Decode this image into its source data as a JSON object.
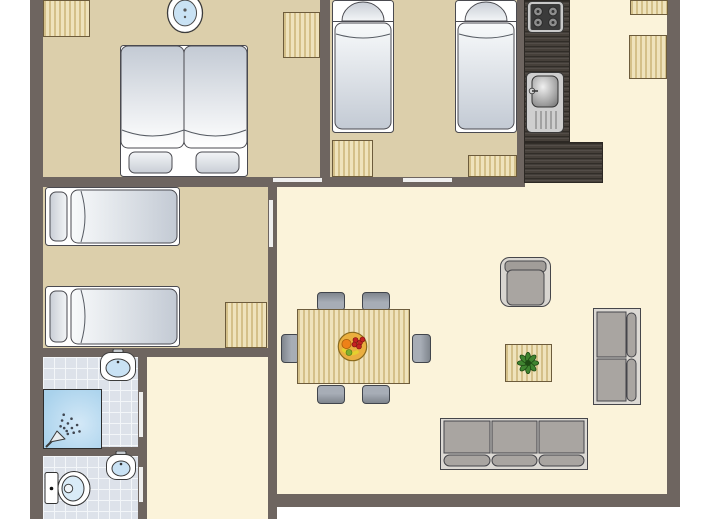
{
  "canvas": {
    "width": 713,
    "height": 519,
    "background": "#ffffff"
  },
  "palette": {
    "wall": "#6e6560",
    "door": "#efefef",
    "floor_bedroom": "#dccfab",
    "floor_living": "#fbf3da",
    "floor_tile": "#dde2ea",
    "tile_line": "#f3f6f9",
    "wood": "#e9d9a7",
    "wood_edge": "#6d5c3c",
    "counter_wood": "#46403a",
    "counter_edge": "#2c2824",
    "outline": "#4a4a50",
    "white": "#ffffff",
    "mattress_light": "#f8fafb",
    "mattress_dark": "#c3cad4",
    "pillow_light": "#f3f5f7",
    "pillow_dark": "#c9ced6",
    "cushion": "#a9a5a1",
    "sofa_frame": "#dcd9d4",
    "armchair_frame": "#d8d5d0",
    "armchair_back": "#a19d99",
    "chair_light": "#a7adb6",
    "chair_dark": "#7f858d",
    "metal_light": "#c9c9c9",
    "metal_dark": "#3b3b3b",
    "burner": "#8e8e8e",
    "sink_blue": "#c9e2f4",
    "shower_blue_1": "#d3e8f7",
    "shower_blue_2": "#a9d2ec",
    "plant_leaf": "#3f8430",
    "plant_dark": "#1e4a14",
    "fruit_base": "#eaaf3f",
    "fruit_red": "#c32222",
    "fruit_orange": "#ee8118",
    "fruit_yellow": "#e6cf2e",
    "fruit_green": "#7fae2e"
  },
  "floors": [
    {
      "name": "bedroom-1-floor",
      "kind": "tan",
      "rect": [
        43,
        0,
        277,
        177
      ]
    },
    {
      "name": "bedroom-2-floor",
      "kind": "tan",
      "rect": [
        330,
        0,
        187,
        177
      ]
    },
    {
      "name": "bedroom-3-floor",
      "kind": "tan",
      "rect": [
        43,
        187,
        225,
        161
      ]
    },
    {
      "name": "bathroom-floor",
      "kind": "tile",
      "rect": [
        43,
        357,
        95,
        90
      ]
    },
    {
      "name": "toilet-floor",
      "kind": "tile",
      "rect": [
        43,
        456,
        95,
        63
      ]
    },
    {
      "name": "hallway-floor",
      "kind": "cream",
      "rect": [
        147,
        357,
        121,
        162
      ]
    },
    {
      "name": "kitchen-floor",
      "kind": "cream",
      "rect": [
        524,
        0,
        143,
        187
      ]
    },
    {
      "name": "living-room-floor",
      "kind": "cream",
      "rect": [
        277,
        187,
        390,
        307
      ]
    }
  ],
  "walls": [
    {
      "name": "outer-wall-left",
      "rect": [
        30,
        0,
        13,
        519
      ]
    },
    {
      "name": "outer-wall-right",
      "rect": [
        667,
        0,
        13,
        507
      ]
    },
    {
      "name": "outer-wall-bottom",
      "rect": [
        268,
        494,
        412,
        13
      ]
    },
    {
      "name": "wall-bedrooms-south",
      "rect": [
        43,
        177,
        482,
        10
      ]
    },
    {
      "name": "wall-bedroom1-bedroom2",
      "rect": [
        320,
        0,
        10,
        177
      ]
    },
    {
      "name": "wall-bedroom2-kitchen",
      "rect": [
        517,
        0,
        8,
        183
      ]
    },
    {
      "name": "wall-living-west",
      "rect": [
        268,
        187,
        9,
        332
      ]
    },
    {
      "name": "wall-bedroom3-south",
      "rect": [
        43,
        348,
        234,
        9
      ]
    },
    {
      "name": "wall-bathroom-east",
      "rect": [
        138,
        357,
        9,
        162
      ]
    },
    {
      "name": "wall-bathroom-toilet",
      "rect": [
        30,
        447,
        117,
        9
      ]
    }
  ],
  "door_markers": [
    {
      "name": "door-bedroom1",
      "rect": [
        273,
        178,
        49,
        4
      ]
    },
    {
      "name": "door-bedroom2",
      "rect": [
        403,
        178,
        49,
        4
      ]
    },
    {
      "name": "door-bedroom3",
      "rect": [
        269,
        200,
        4,
        47
      ]
    },
    {
      "name": "door-bathroom",
      "rect": [
        139,
        392,
        4,
        45
      ]
    },
    {
      "name": "door-toilet",
      "rect": [
        139,
        467,
        4,
        35
      ]
    }
  ],
  "furniture": [
    {
      "type": "wood",
      "name": "wardrobe-bedroom1-a",
      "rect": [
        43,
        0,
        47,
        37
      ]
    },
    {
      "type": "wood",
      "name": "wardrobe-bedroom1-b",
      "rect": [
        283,
        12,
        37,
        46
      ]
    },
    {
      "type": "wood",
      "name": "wardrobe-bedroom2-a",
      "rect": [
        332,
        140,
        41,
        37
      ]
    },
    {
      "type": "wood",
      "name": "wardrobe-bedroom2-b",
      "rect": [
        468,
        155,
        49,
        22
      ]
    },
    {
      "type": "wood",
      "name": "wardrobe-bedroom3",
      "rect": [
        225,
        302,
        42,
        46
      ]
    },
    {
      "type": "wood",
      "name": "cabinet-right-a",
      "rect": [
        630,
        0,
        38,
        15
      ]
    },
    {
      "type": "wood",
      "name": "cabinet-right-b",
      "rect": [
        629,
        35,
        38,
        44
      ]
    },
    {
      "type": "counter",
      "name": "kitchen-counter-long",
      "rect": [
        524,
        0,
        46,
        142
      ]
    },
    {
      "type": "counter",
      "name": "kitchen-counter-ell",
      "rect": [
        524,
        142,
        79,
        41
      ]
    },
    {
      "type": "stove",
      "name": "stove",
      "rect": [
        527,
        1,
        37,
        32
      ]
    },
    {
      "type": "kitchen-sink",
      "name": "kitchen-sink",
      "rect": [
        526,
        72,
        38,
        61
      ]
    },
    {
      "type": "bed-double",
      "name": "double-bed",
      "rect": [
        120,
        45,
        128,
        132
      ]
    },
    {
      "type": "bed-single-v",
      "name": "single-bed-a",
      "rect": [
        332,
        0,
        62,
        133
      ]
    },
    {
      "type": "bed-single-v",
      "name": "single-bed-b",
      "rect": [
        455,
        0,
        62,
        133
      ]
    },
    {
      "type": "bed-single-h",
      "name": "single-bed-c",
      "rect": [
        45,
        187,
        135,
        59
      ]
    },
    {
      "type": "bed-single-h",
      "name": "single-bed-d",
      "rect": [
        45,
        286,
        135,
        61
      ]
    },
    {
      "type": "sink-round",
      "name": "washbasin-bedroom1",
      "rect": [
        166,
        -8,
        38,
        42
      ]
    },
    {
      "type": "sink-square",
      "name": "washbasin-bathroom",
      "rect": [
        100,
        349,
        36,
        32
      ]
    },
    {
      "type": "shower",
      "name": "shower",
      "rect": [
        43,
        389,
        59,
        60
      ]
    },
    {
      "type": "sink-square",
      "name": "washbasin-toilet",
      "rect": [
        106,
        451,
        30,
        29
      ]
    },
    {
      "type": "toilet",
      "name": "toilet",
      "rect": [
        44,
        470,
        48,
        37
      ]
    },
    {
      "type": "chair",
      "dir": "bottom",
      "name": "dining-chair-top-1",
      "rect": [
        317,
        292,
        28,
        19
      ]
    },
    {
      "type": "chair",
      "dir": "bottom",
      "name": "dining-chair-top-2",
      "rect": [
        362,
        292,
        28,
        19
      ]
    },
    {
      "type": "chair",
      "dir": "top",
      "name": "dining-chair-bottom-1",
      "rect": [
        317,
        385,
        28,
        19
      ]
    },
    {
      "type": "chair",
      "dir": "top",
      "name": "dining-chair-bottom-2",
      "rect": [
        362,
        385,
        28,
        19
      ]
    },
    {
      "type": "chair",
      "dir": "right",
      "name": "dining-chair-left",
      "rect": [
        281,
        334,
        19,
        29
      ]
    },
    {
      "type": "chair",
      "dir": "left",
      "name": "dining-chair-right",
      "rect": [
        412,
        334,
        19,
        29
      ]
    },
    {
      "type": "wood",
      "name": "dining-table",
      "rect": [
        297,
        309,
        113,
        75
      ]
    },
    {
      "type": "fruit-bowl",
      "name": "fruit-bowl",
      "rect": [
        337,
        331,
        31,
        31
      ]
    },
    {
      "type": "armchair",
      "name": "armchair",
      "rect": [
        500,
        257,
        51,
        50
      ]
    },
    {
      "type": "wood",
      "name": "side-table",
      "rect": [
        505,
        344,
        47,
        38
      ]
    },
    {
      "type": "plant",
      "name": "plant",
      "rect": [
        517,
        352,
        22,
        22
      ]
    },
    {
      "type": "sofa-v",
      "name": "sofa-two-seat",
      "rect": [
        593,
        308,
        48,
        97
      ]
    },
    {
      "type": "sofa-h",
      "name": "sofa-three-seat",
      "rect": [
        440,
        418,
        148,
        52
      ]
    }
  ]
}
